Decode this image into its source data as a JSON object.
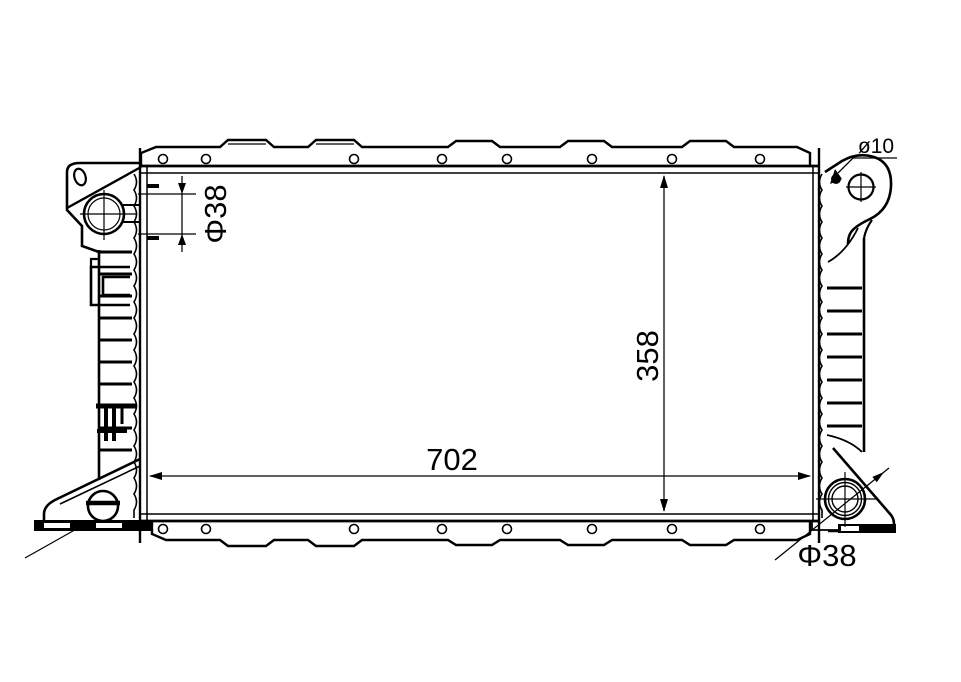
{
  "drawing": {
    "background": "#ffffff",
    "line_color": "#000000",
    "dimensions": {
      "inlet_diameter_label": "Φ38",
      "bracket_hole_label": "ø10",
      "core_height_label": "358",
      "core_width_label": "702",
      "outlet_diameter_label": "Φ38"
    }
  }
}
